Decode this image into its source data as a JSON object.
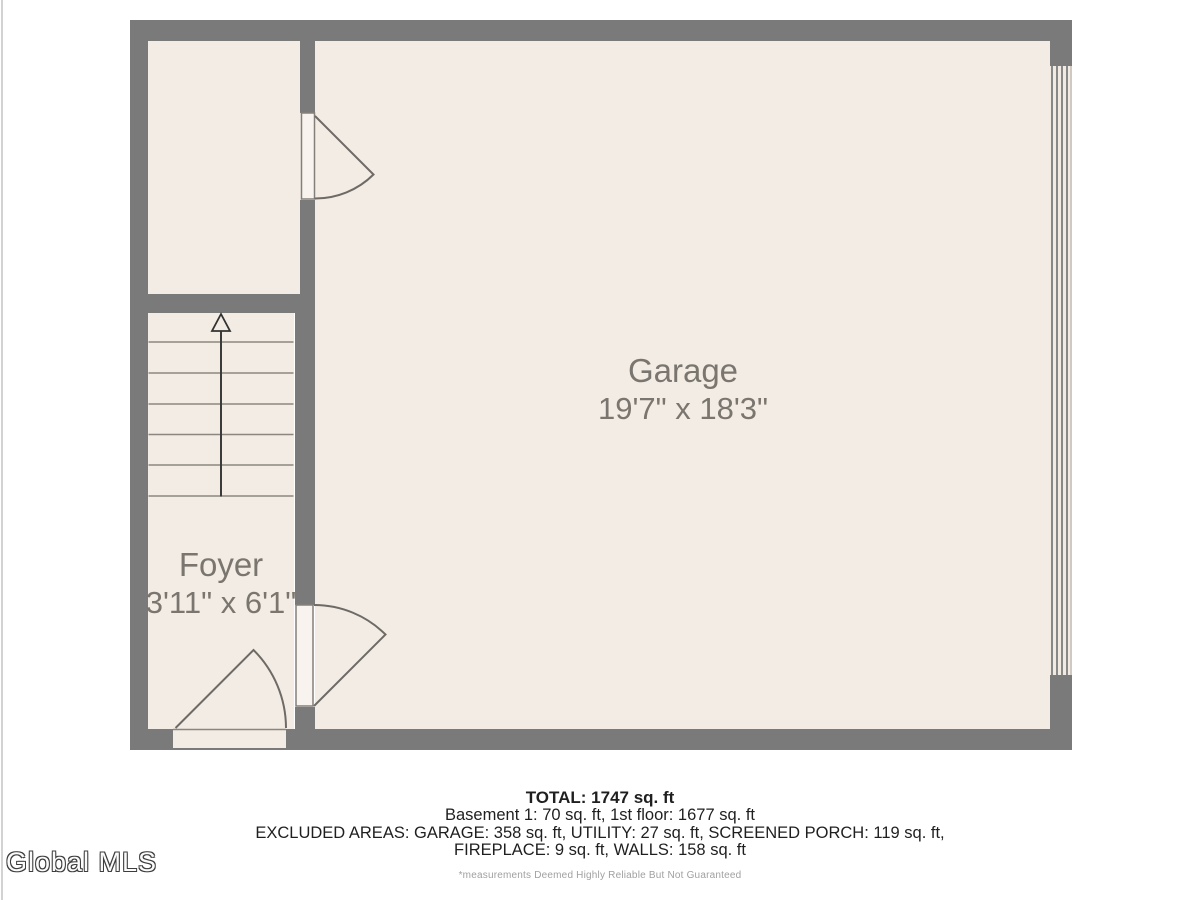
{
  "floorplan": {
    "rooms": [
      {
        "name": "Garage",
        "dims": "19'7\" x 18'3\""
      },
      {
        "name": "Foyer",
        "dims": "3'11\" x 6'1\""
      }
    ],
    "icons": [
      "stairs-up-arrow-icon",
      "door-swing-icon-upper",
      "door-swing-icon-foyer-garage",
      "door-swing-icon-entry",
      "garage-door-panel-icon"
    ]
  },
  "summary": {
    "total": "TOTAL: 1747 sq. ft",
    "floors": "Basement 1: 70 sq. ft, 1st floor: 1677 sq. ft",
    "excluded1": "EXCLUDED AREAS: GARAGE: 358 sq. ft, UTILITY: 27 sq. ft, SCREENED PORCH: 119 sq. ft,",
    "excluded2": "FIREPLACE: 9 sq. ft, WALLS: 158 sq. ft",
    "disclaimer": "*measurements Deemed Highly Reliable But Not Guaranteed"
  },
  "watermark": {
    "text": "Global MLS"
  },
  "colors": {
    "wall": "#7a7a7a",
    "floor": "#f3ece5",
    "door_leaf": "#f8f3ee",
    "plan_line": "#6e6a65",
    "label_text": "#7a766f",
    "summary_text": "#1f1f1f",
    "disclaimer_text": "#a0a0a0"
  }
}
